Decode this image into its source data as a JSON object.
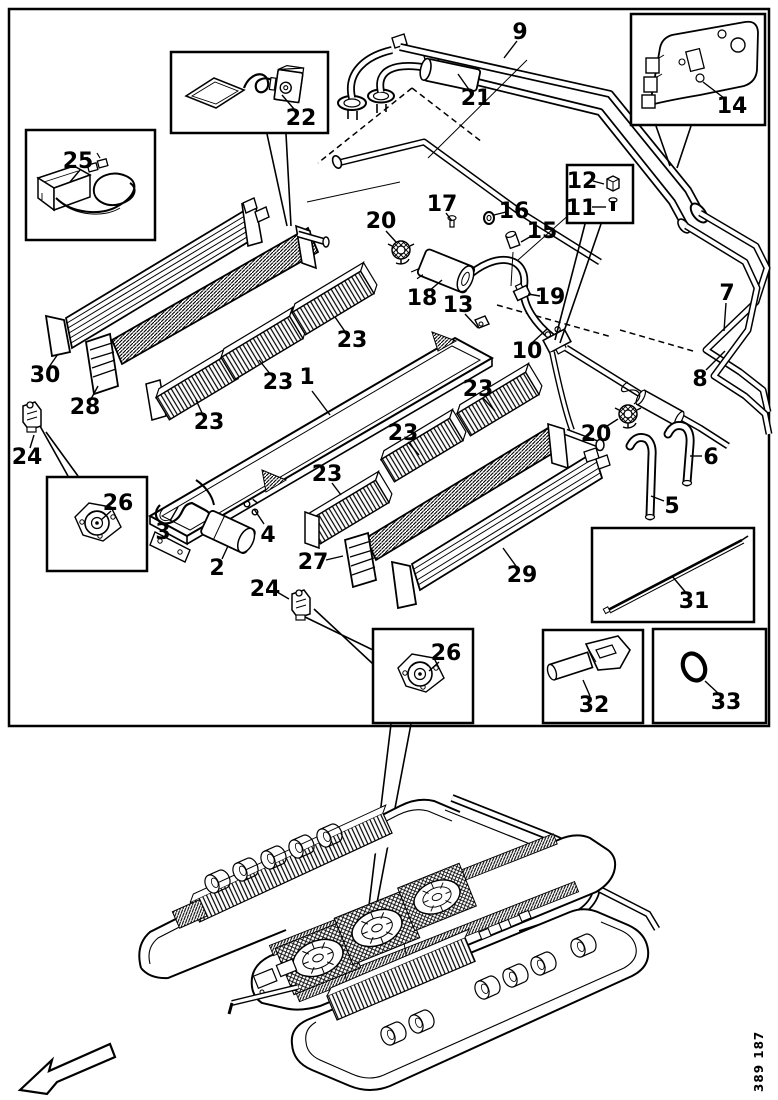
{
  "figure": {
    "code": "389 187",
    "type_label": "exploded parts diagram, roof air-conditioning unit"
  },
  "palette": {
    "ink": "#000000",
    "paper": "#ffffff"
  },
  "callouts": [
    {
      "n": "1",
      "x": 307,
      "y": 384,
      "leader": [
        312,
        391,
        330,
        415
      ]
    },
    {
      "n": "2",
      "x": 217,
      "y": 575,
      "leader": [
        222,
        559,
        228,
        546
      ]
    },
    {
      "n": "3",
      "x": 163,
      "y": 539,
      "leader": [
        170,
        521,
        178,
        507
      ]
    },
    {
      "n": "4",
      "x": 268,
      "y": 542,
      "leader": [
        264,
        524,
        254,
        509
      ]
    },
    {
      "n": "5",
      "x": 672,
      "y": 513,
      "leader": [
        664,
        501,
        651,
        496
      ]
    },
    {
      "n": "6",
      "x": 711,
      "y": 464,
      "leader": [
        702,
        456,
        690,
        456
      ]
    },
    {
      "n": "7",
      "x": 727,
      "y": 300,
      "leader": [
        726,
        303,
        724,
        331
      ]
    },
    {
      "n": "8",
      "x": 700,
      "y": 386,
      "leader": [
        706,
        370,
        725,
        351
      ]
    },
    {
      "n": "9",
      "x": 520,
      "y": 39,
      "leader": [
        517,
        41,
        504,
        58
      ]
    },
    {
      "n": "10",
      "x": 527,
      "y": 358,
      "leader": [
        533,
        342,
        547,
        329
      ]
    },
    {
      "n": "11",
      "x": 581,
      "y": 215,
      "leader": [
        592,
        207,
        606,
        207
      ]
    },
    {
      "n": "12",
      "x": 582,
      "y": 188,
      "leader": [
        593,
        181,
        604,
        184
      ]
    },
    {
      "n": "13",
      "x": 458,
      "y": 312,
      "leader": [
        465,
        314,
        478,
        328
      ]
    },
    {
      "n": "14",
      "x": 732,
      "y": 113,
      "leader": [
        724,
        98,
        703,
        82
      ]
    },
    {
      "n": "15",
      "x": 542,
      "y": 238,
      "leader": [
        535,
        234,
        521,
        242
      ]
    },
    {
      "n": "16",
      "x": 514,
      "y": 218,
      "leader": [
        506,
        212,
        494,
        215
      ]
    },
    {
      "n": "17",
      "x": 442,
      "y": 211,
      "leader": [
        446,
        213,
        452,
        221
      ]
    },
    {
      "n": "18",
      "x": 422,
      "y": 305,
      "leader": [
        429,
        291,
        442,
        280
      ]
    },
    {
      "n": "19",
      "x": 550,
      "y": 304,
      "leader": [
        540,
        296,
        528,
        294
      ]
    },
    {
      "n": "20",
      "x": 381,
      "y": 228,
      "leader": [
        386,
        231,
        396,
        242
      ]
    },
    {
      "n": "20",
      "x": 596,
      "y": 441,
      "leader": [
        604,
        428,
        618,
        419
      ]
    },
    {
      "n": "21",
      "x": 476,
      "y": 105,
      "leader": [
        470,
        91,
        458,
        74
      ]
    },
    {
      "n": "22",
      "x": 301,
      "y": 125,
      "leader": [
        294,
        109,
        282,
        95
      ]
    },
    {
      "n": "23",
      "x": 352,
      "y": 347,
      "leader": [
        346,
        333,
        335,
        317
      ]
    },
    {
      "n": "23",
      "x": 278,
      "y": 389,
      "leader": [
        271,
        375,
        259,
        360
      ]
    },
    {
      "n": "23",
      "x": 209,
      "y": 429,
      "leader": [
        203,
        415,
        196,
        400
      ]
    },
    {
      "n": "23",
      "x": 478,
      "y": 396,
      "leader": [
        483,
        398,
        495,
        411
      ]
    },
    {
      "n": "23",
      "x": 403,
      "y": 440,
      "leader": [
        408,
        442,
        419,
        455
      ]
    },
    {
      "n": "23",
      "x": 327,
      "y": 481,
      "leader": [
        332,
        483,
        341,
        495
      ]
    },
    {
      "n": "24",
      "x": 27,
      "y": 464,
      "leader": [
        30,
        448,
        34,
        435
      ]
    },
    {
      "n": "24",
      "x": 265,
      "y": 596,
      "leader": [
        277,
        592,
        289,
        599
      ]
    },
    {
      "n": "25",
      "x": 78,
      "y": 168,
      "leader": [
        80,
        170,
        70,
        182
      ]
    },
    {
      "n": "26",
      "x": 118,
      "y": 510,
      "leader": [
        111,
        511,
        101,
        520
      ]
    },
    {
      "n": "26",
      "x": 446,
      "y": 660,
      "leader": [
        439,
        662,
        429,
        671
      ]
    },
    {
      "n": "27",
      "x": 313,
      "y": 569,
      "leader": [
        326,
        560,
        343,
        556
      ]
    },
    {
      "n": "28",
      "x": 85,
      "y": 414,
      "leader": [
        91,
        399,
        98,
        386
      ]
    },
    {
      "n": "29",
      "x": 522,
      "y": 582,
      "leader": [
        516,
        566,
        503,
        548
      ]
    },
    {
      "n": "30",
      "x": 45,
      "y": 382,
      "leader": [
        49,
        367,
        58,
        354
      ]
    },
    {
      "n": "31",
      "x": 694,
      "y": 608,
      "leader": [
        687,
        594,
        672,
        576
      ]
    },
    {
      "n": "32",
      "x": 594,
      "y": 712,
      "leader": [
        590,
        696,
        583,
        680
      ]
    },
    {
      "n": "33",
      "x": 726,
      "y": 709,
      "leader": [
        719,
        694,
        705,
        681
      ]
    }
  ]
}
